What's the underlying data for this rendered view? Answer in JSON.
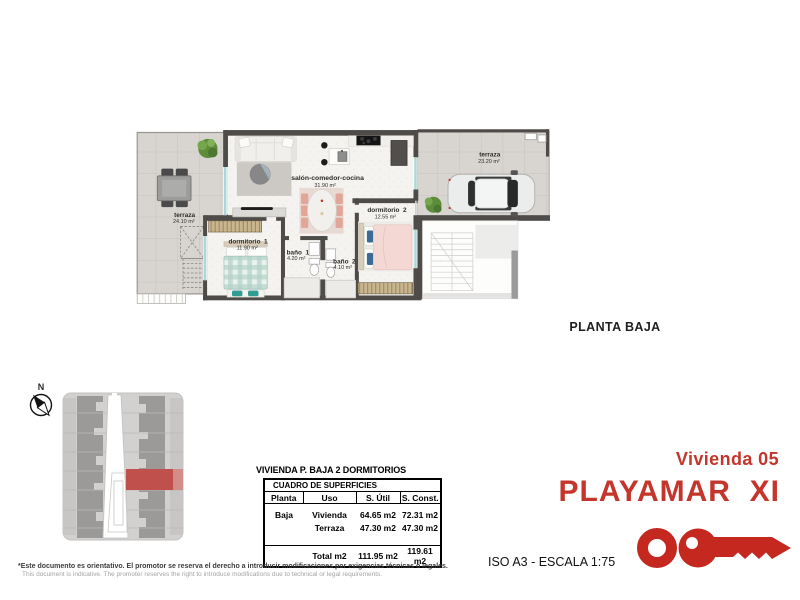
{
  "floor_plan": {
    "caption": "PLANTA BAJA",
    "rooms": {
      "terraza_left": {
        "name": "terraza",
        "area": "24.10 m²"
      },
      "salon": {
        "name": "salón-comedor-cocina",
        "area": "31.90 m²"
      },
      "dormitorio1": {
        "name": "dormitorio  1",
        "area": "11.90 m²"
      },
      "bano1": {
        "name": "baño  1",
        "area": "4.20 m²"
      },
      "bano2": {
        "name": "baño  2",
        "area": "4.10 m²"
      },
      "dormitorio2": {
        "name": "dormitorio  2",
        "area": "12.55 m²"
      },
      "terraza_right": {
        "name": "terraza",
        "area": "23.20 m²"
      }
    }
  },
  "site_plan": {
    "north_label": "N"
  },
  "surfaces_table": {
    "title": "VIVIENDA P. BAJA 2 DORMITORIOS",
    "header": "CUADRO DE SUPERFICIES",
    "columns": [
      "Planta",
      "Uso",
      "S. Útil",
      "S. Const."
    ],
    "rows": [
      {
        "planta": "Baja",
        "uso": "Vivienda",
        "util": "64.65 m2",
        "const": "72.31 m2"
      },
      {
        "planta": "",
        "uso": "Terraza",
        "util": "47.30 m2",
        "const": "47.30 m2"
      }
    ],
    "total": {
      "label": "Total m2",
      "util": "111.95 m2",
      "const": "119.61 m2"
    }
  },
  "branding": {
    "unit": "Vivienda 05",
    "project": "PLAYAMAR  XI",
    "scale": "ISO A3 - ESCALA 1:75"
  },
  "disclaimer": {
    "es": "*Este documento es orientativo. El promotor se reserva el derecho a introducir modificaciones por exigencias técnicas o legales.",
    "en": "This document is indicative. The promoter reserves the right to introduce modifications due to technical or legal requirements."
  },
  "icons": {
    "logo": "key-ring-logo",
    "compass": "north-compass-icon"
  },
  "colors": {
    "brand_red": "#c4352c",
    "site_highlight": "#c0504b",
    "wall": "#4e4b48",
    "bed_teal": "#a8cdc5",
    "bed_pink": "#f3d8d4"
  }
}
